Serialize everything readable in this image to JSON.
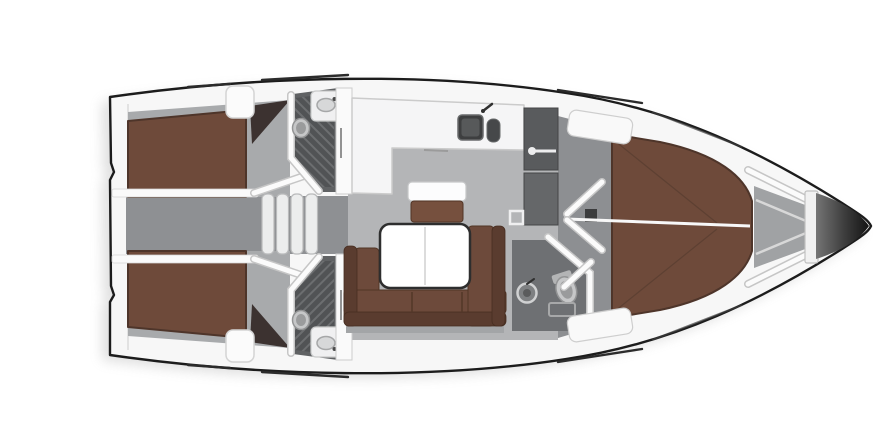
{
  "meta": {
    "title": "sailing-yacht-interior-floorplan-top-view",
    "canvas": {
      "width": 890,
      "height": 446
    }
  },
  "colors": {
    "bg": "#ffffff",
    "hull_outline": "#1c1c1c",
    "hull_fill": "#f7f7f7",
    "bed_brown": "#6e4a3a",
    "bed_dark": "#4e352a",
    "sofa_brown": "#6d4a3b",
    "sofa_back": "#5a3c2f",
    "stool_brown": "#76503e",
    "table_edge": "#2e2e2e",
    "floor_salon": "#b4b5b7",
    "floor_cabin": "#a8aaac",
    "floor_corridor": "#8e9093",
    "floor_passage": "#8d8f92",
    "head_dark": "#606264",
    "column_dark": "#595b5d",
    "wedge": "#3c3230",
    "bow_tip": "#141414",
    "rail": "#2b2b2b",
    "fixture_light": "#d7d8d9",
    "locker_floor": "#a0a2a4"
  },
  "rooms": [
    {
      "id": "aft-cabin-port",
      "name": "aft double cabin (top)"
    },
    {
      "id": "aft-cabin-starboard",
      "name": "aft double cabin (bottom)"
    },
    {
      "id": "aft-head-port",
      "name": "aft bathroom with shower (top)"
    },
    {
      "id": "aft-head-starboard",
      "name": "aft bathroom with shower (bottom)"
    },
    {
      "id": "companionway",
      "name": "companionway corridor with steps"
    },
    {
      "id": "galley",
      "name": "L-shaped galley with double sink"
    },
    {
      "id": "salon",
      "name": "salon with U-sofa, table and stool"
    },
    {
      "id": "wet-locker",
      "name": "wardrobe / wet locker column"
    },
    {
      "id": "passageway",
      "name": "forward passage with open doors"
    },
    {
      "id": "forward-head",
      "name": "forward bathroom"
    },
    {
      "id": "forward-cabin",
      "name": "forward cabin with V-berth"
    },
    {
      "id": "anchor-locker",
      "name": "anchor locker"
    },
    {
      "id": "bow",
      "name": "bow cone"
    }
  ],
  "features": [
    "hull-outline",
    "double-berth",
    "v-berth",
    "companionway-steps",
    "u-shaped-sofa",
    "salon-table",
    "stool",
    "galley-sink",
    "faucet",
    "toilet",
    "washbasin",
    "shower-grate",
    "towel-rail",
    "door-leaf",
    "deck-handrail",
    "anchor-locker-beams",
    "bow-cone"
  ]
}
